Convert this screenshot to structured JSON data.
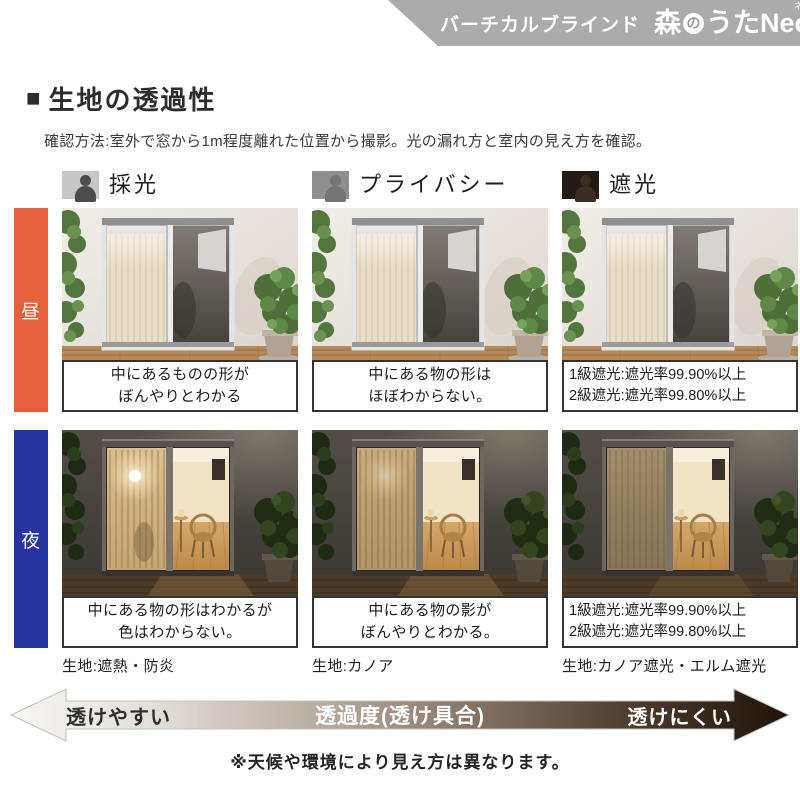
{
  "header": {
    "series_label": "バーチカルブラインド",
    "brand": {
      "mori": "森",
      "no": "の",
      "uta": "うた",
      "neo": "Neo",
      "neo_ruby": "ネオ"
    },
    "bar_color": "#ababab"
  },
  "section": {
    "title_marker": "■",
    "title": "生地の透過性",
    "description": "確認方法:室外で窓から1m程度離れた位置から撮影。光の漏れ方と室内の見え方を確認。"
  },
  "columns": [
    {
      "label": "採光",
      "icon": "person-visible-icon"
    },
    {
      "label": "プライバシー",
      "icon": "person-faint-icon"
    },
    {
      "label": "遮光",
      "icon": "person-hidden-icon"
    }
  ],
  "rows": [
    {
      "label": "昼",
      "color": "#e4613b"
    },
    {
      "label": "夜",
      "color": "#2734a0"
    }
  ],
  "cells": {
    "day": [
      {
        "caption_line1": "中にあるものの形が",
        "caption_line2": "ぼんやりとわかる"
      },
      {
        "caption_line1": "中にある物の形は",
        "caption_line2": "ほぼわからない。"
      },
      {
        "caption_line1": "1級遮光:遮光率99.90%以上",
        "caption_line2": "2級遮光:遮光率99.80%以上"
      }
    ],
    "night": [
      {
        "caption_line1": "中にある物の形はわかるが",
        "caption_line2": "色はわからない。",
        "fabric": "生地:遮熱・防炎"
      },
      {
        "caption_line1": "中にある物の影が",
        "caption_line2": "ぼんやりとわかる。",
        "fabric": "生地:カノア"
      },
      {
        "caption_line1": "1級遮光:遮光率99.90%以上",
        "caption_line2": "2級遮光:遮光率99.80%以上",
        "fabric": "生地:カノア遮光・エルム遮光"
      }
    ]
  },
  "scale": {
    "left_label": "透けやすい",
    "center_label": "透過度(透け具合)",
    "right_label": "透けにくい",
    "gradient": [
      "#f7f6f5",
      "#b3a79c",
      "#7d6c5f",
      "#201309"
    ]
  },
  "footnote": "※天候や環境により見え方は異なります。"
}
